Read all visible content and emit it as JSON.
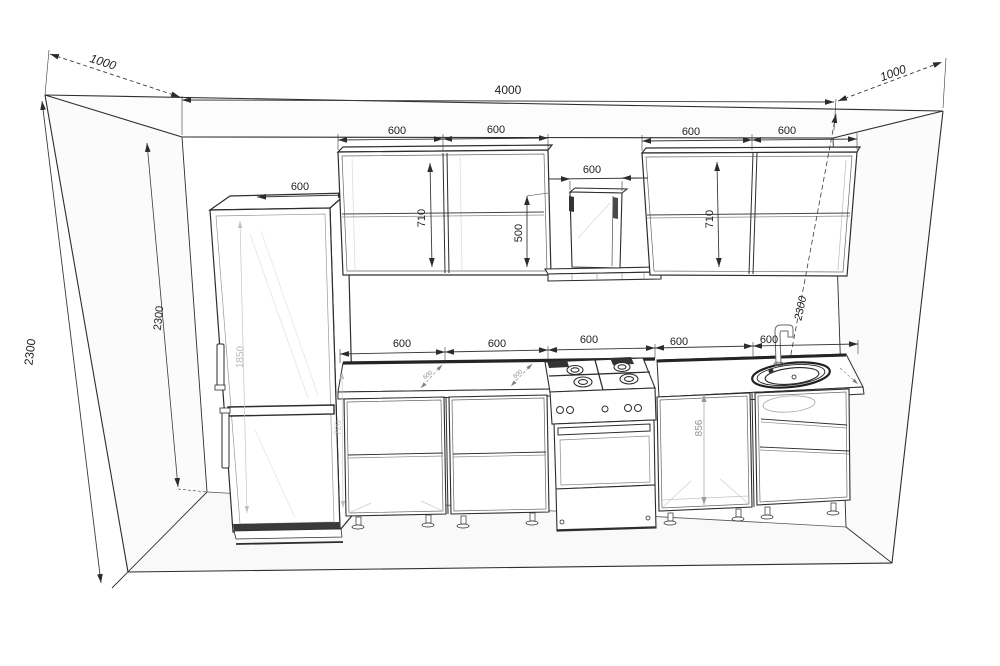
{
  "meta": {
    "title": "Kitchen 3D elevation drawing"
  },
  "dims": {
    "room_width": "4000",
    "room_height": "2300",
    "depth_left": "1000",
    "depth_right": "1000",
    "inner_height": "2300",
    "inner_height_right": "2300",
    "fridge_width": "600",
    "fridge_inner_height": "1850",
    "upper_left_1": "600",
    "upper_left_2": "600",
    "upper_height_left": "710",
    "hood_width": "600",
    "hood_space": "500",
    "upper_right_1": "600",
    "upper_right_2": "600",
    "upper_height_right": "710",
    "base_1": "600",
    "base_2": "600",
    "base_3": "600",
    "base_4": "600",
    "base_5": "600",
    "base_height": "856",
    "carcass_height": "720",
    "counter_depth_1": "600",
    "counter_depth_2": "600"
  }
}
